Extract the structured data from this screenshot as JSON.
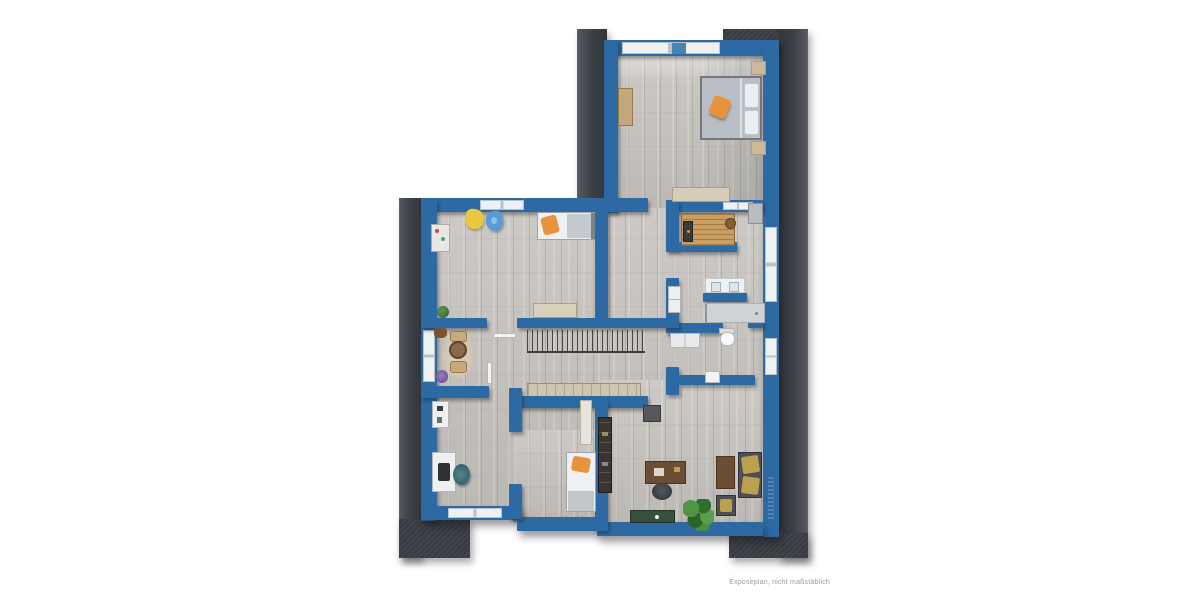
{
  "annotation": {
    "disclaimer": "Exposeplan, nicht maßstäblich"
  },
  "colors": {
    "wall_blue": "#2d6aa3",
    "roof_dark": "#3b3e44",
    "floor_light": "#c7c4bf",
    "accent_orange": "#e8933c",
    "wood_sauna": "#c89e62",
    "plant_green": "#3f7d3a",
    "gold": "#bd9f50",
    "stair_tan": "#cfc5ae"
  },
  "plan": {
    "type": "floor-plan",
    "style": "3d-top-down-render",
    "rooms": [
      {
        "id": "bedroom-top",
        "furniture": [
          "double-bed",
          "orange-cushion",
          "nightstand-left",
          "nightstand-right",
          "wardrobe",
          "sideboard"
        ]
      },
      {
        "id": "sauna",
        "furniture": [
          "sauna-bench",
          "sauna-heater",
          "bucket",
          "corner-cabinet"
        ]
      },
      {
        "id": "bathroom",
        "furniture": [
          "double-vanity",
          "shower",
          "stacked-washer"
        ]
      },
      {
        "id": "wc-laundry",
        "furniture": [
          "toilet",
          "washer-dryer",
          "small-sink"
        ]
      },
      {
        "id": "kids-room",
        "furniture": [
          "single-bed",
          "orange-pillow",
          "wall-shelf",
          "yellow-cushion",
          "blue-cushion",
          "dresser"
        ]
      },
      {
        "id": "sitting-room",
        "furniture": [
          "round-rug",
          "cat-tree",
          "pouf",
          "potted-plant",
          "purple-plant"
        ]
      },
      {
        "id": "office",
        "furniture": [
          "desk",
          "laptop",
          "desk-chair",
          "side-table"
        ]
      },
      {
        "id": "bedroom-2",
        "furniture": [
          "single-bed",
          "orange-pillow",
          "open-wardrobe",
          "door-leaf"
        ]
      },
      {
        "id": "living-study",
        "furniture": [
          "desk",
          "office-chair",
          "tv-board",
          "cabinet",
          "chaise-lounge",
          "ottoman",
          "monstera-plant",
          "green-bench"
        ]
      },
      {
        "id": "hallway-stairs",
        "furniture": [
          "staircase",
          "railing",
          "door-leaves"
        ]
      }
    ]
  }
}
